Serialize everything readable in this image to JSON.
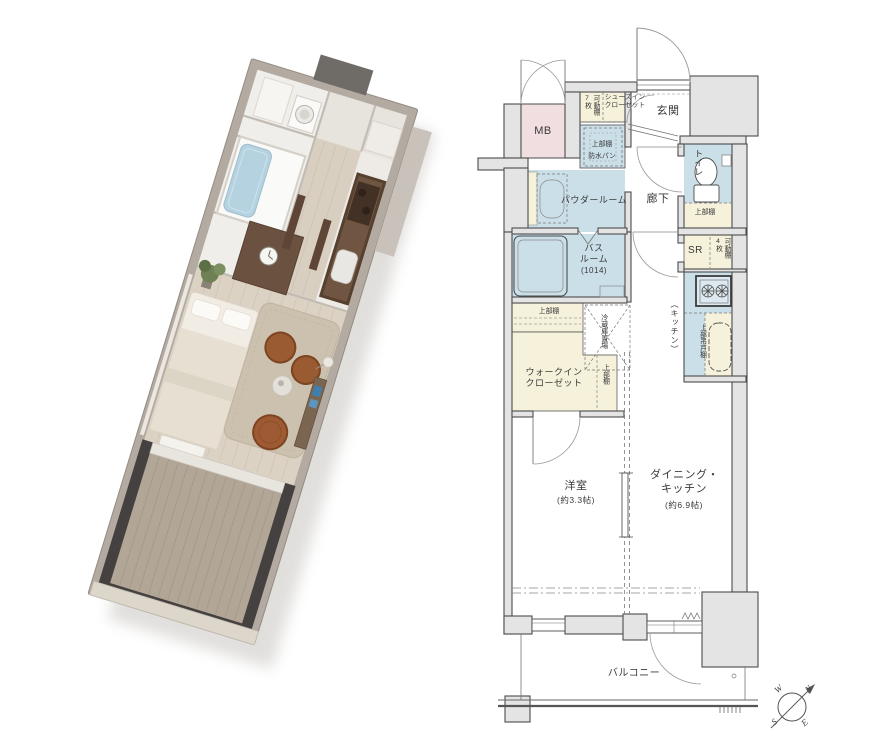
{
  "colors": {
    "closet_cream": "#f5f1da",
    "wet_area_blue": "#cbdfe9",
    "mb_pink": "#f1dee1",
    "wall_gray": "#e4e4e4",
    "outline": "#4c4c4c",
    "balcony_dark_3d": "#454140",
    "wood_floor_3d": "#dcd2c4",
    "leather_chair_3d": "#9a5a32",
    "bathtub_blue_3d": "#b5d2e0"
  },
  "plan": {
    "mb": {
      "label": "MB"
    },
    "shoes_in_closet": {
      "shelf_line1": "可動棚",
      "shelf_line2": "7枚",
      "line1": "シューズイン",
      "line2": "クローゼット"
    },
    "entrance": {
      "label": "玄関"
    },
    "laundry": {
      "upper_shelf": "上部棚",
      "pan": "防水パン"
    },
    "powder_room": {
      "label": "パウダールーム"
    },
    "hallway": {
      "label": "廊下"
    },
    "toilet": {
      "label": "トイレ",
      "upper_shelf": "上部棚"
    },
    "service_room": {
      "label": "SR",
      "shelf_line1": "可動棚",
      "shelf_line2": "4枚"
    },
    "bathroom": {
      "line1": "バス",
      "line2": "ルーム",
      "size": "(1014)"
    },
    "kitchen": {
      "label": "（キッチン）",
      "hanging_cupboard": "上部吊戸棚"
    },
    "refrigerator": {
      "label": "冷蔵庫置場"
    },
    "wic": {
      "upper_shelf": "上部棚",
      "line1": "ウォークイン",
      "line2": "クローゼット",
      "side_shelf": "上部棚"
    },
    "western_room": {
      "label": "洋室",
      "size": "(約3.3帖)"
    },
    "dining_kitchen": {
      "line1": "ダイニング・",
      "line2": "キッチン",
      "size": "(約6.9帖)"
    },
    "balcony": {
      "label": "バルコニー"
    }
  },
  "compass": {
    "n": "N",
    "e": "E",
    "s": "S",
    "w": "W"
  }
}
